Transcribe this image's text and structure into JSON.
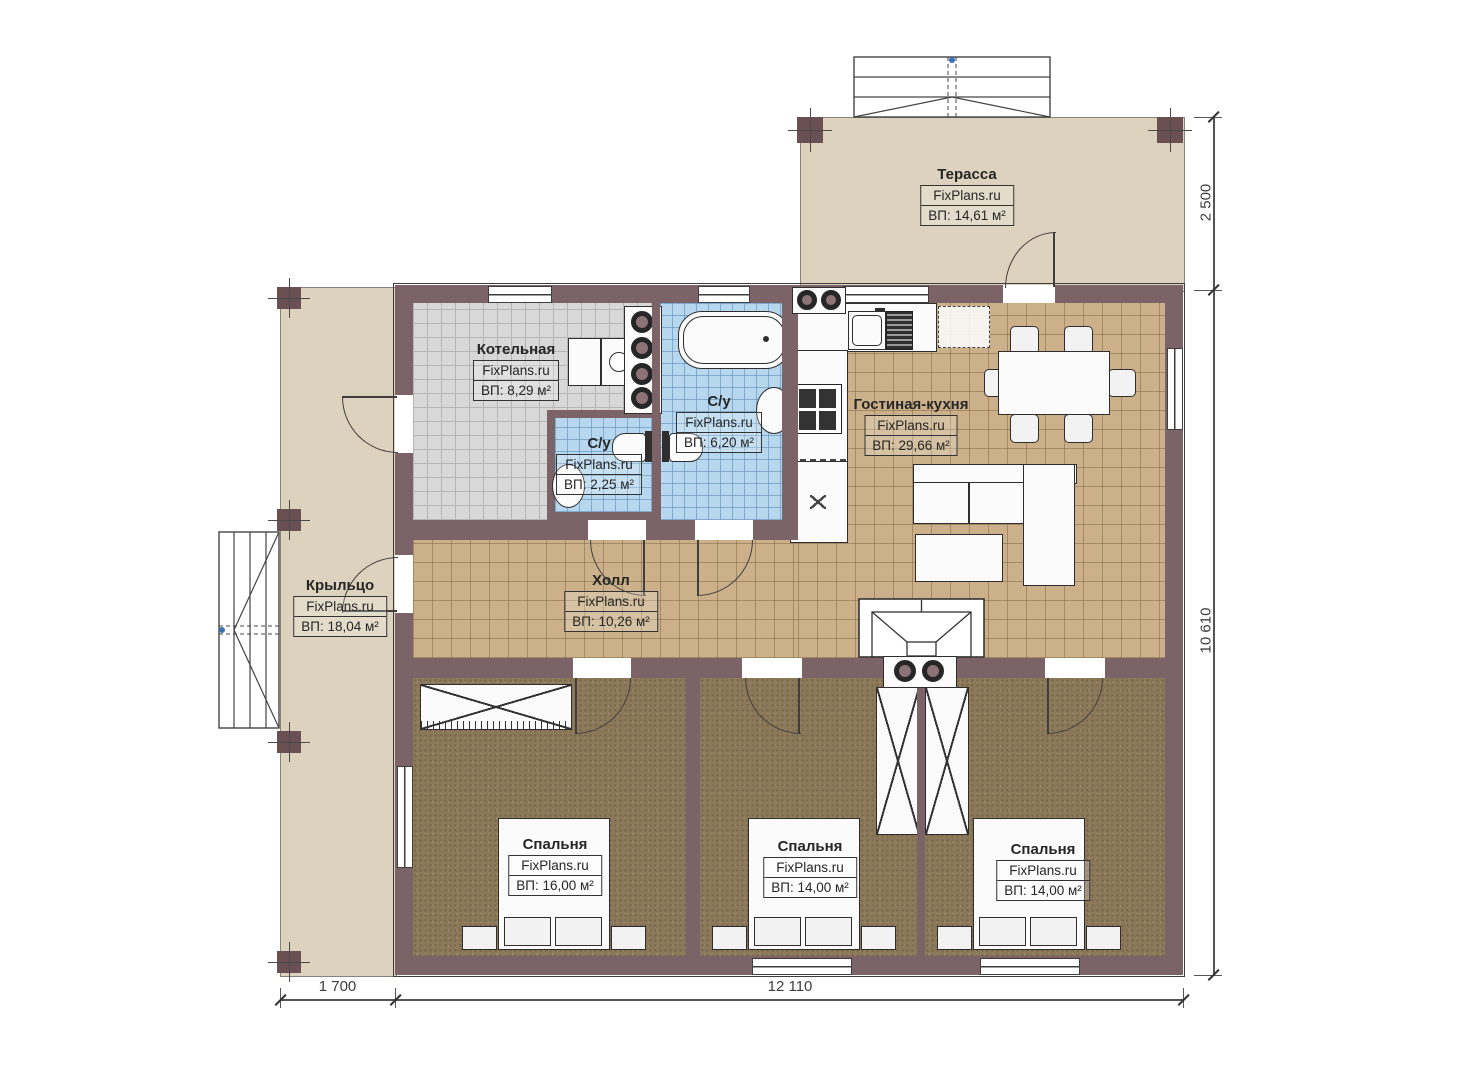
{
  "plan": {
    "brand": "FixPlans.ru",
    "rooms": [
      {
        "name": "Терасса",
        "area": "ВП: 14,61 м²"
      },
      {
        "name": "Котельная",
        "area": "ВП: 8,29 м²"
      },
      {
        "name": "С/у",
        "area": "ВП: 6,20 м²"
      },
      {
        "name": "С/у",
        "area": "ВП: 2,25 м²"
      },
      {
        "name": "Гостиная-кухня",
        "area": "ВП: 29,66 м²"
      },
      {
        "name": "Холл",
        "area": "ВП: 10,26 м²"
      },
      {
        "name": "Крыльцо",
        "area": "ВП: 18,04 м²"
      },
      {
        "name": "Спальня",
        "area": "ВП: 16,00 м²"
      },
      {
        "name": "Спальня",
        "area": "ВП: 14,00 м²"
      },
      {
        "name": "Спальня",
        "area": "ВП: 14,00 м²"
      }
    ],
    "dimensions": {
      "terrace_depth": "2 500",
      "house_depth": "10 610",
      "porch_width": "1 700",
      "house_width": "12 110"
    },
    "colors": {
      "wall": "#7b6367",
      "terrace_floor": "#ddd2bd",
      "tile_tan": "#cbb08a",
      "tile_gray": "#d8d8d8",
      "tile_blue": "#b7d7ee",
      "bedroom_floor": "#8c795a"
    }
  }
}
